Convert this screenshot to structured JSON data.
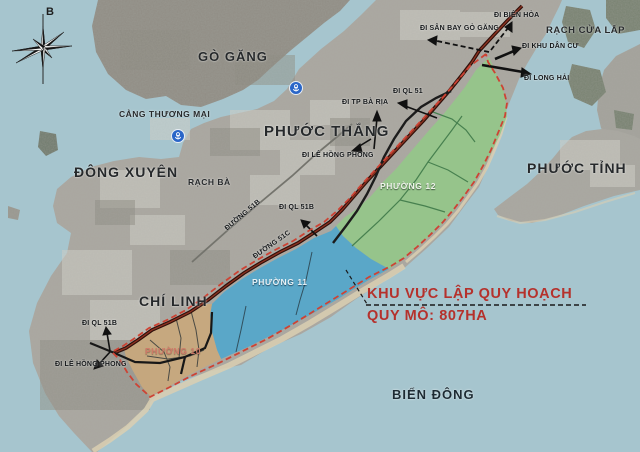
{
  "compass": {
    "north_label": "B"
  },
  "regions": {
    "go_gang": "GÒ GĂNG",
    "phuoc_thang": "PHƯỚC THẮNG",
    "dong_xuyen": "ĐÔNG XUYÊN",
    "phuoc_tinh": "PHƯỚC TỈNH",
    "chi_linh": "CHÍ LINH",
    "bien_dong": "BIỂN ĐÔNG",
    "rach_cua_lap": "RẠCH CỬA LẤP",
    "rach_ba": "RẠCH BÀ",
    "cang_thuong_mai": "CẢNG THƯƠNG MẠI"
  },
  "zones": {
    "p10": {
      "label": "PHƯỜNG 10",
      "color": "#c9a87c"
    },
    "p11": {
      "label": "PHƯỜNG 11",
      "color": "#54a7cb"
    },
    "p12": {
      "label": "PHƯỜNG 12",
      "color": "#95c789"
    }
  },
  "roads": {
    "duong_51b": "ĐƯỜNG 51B",
    "duong_51c": "ĐƯỜNG 51C"
  },
  "directions": {
    "di_san_bay_go_gang": "ĐI SÂN BAY GÒ GĂNG",
    "di_bien_hoa": "ĐI BIÊN HÒA",
    "di_khu_dan_cu": "ĐI KHU DÂN CƯ",
    "di_long_hai": "ĐI LONG HẢI",
    "di_ql_51": "ĐI QL 51",
    "di_tp_ba_ria": "ĐI TP BÀ RỊA",
    "di_le_hong_phong": "ĐI LÊ HỒNG PHONG",
    "di_ql_51b": "ĐI QL 51B",
    "di_ql_51b_south": "ĐI QL 51B",
    "di_le_hong_phong_south": "ĐI LÊ HỒNG PHONG"
  },
  "annotation": {
    "line1": "KHU VỰC LẬP QUY HOẠCH",
    "line2": "QUY MÔ: 807HA"
  },
  "colors": {
    "sea": "#a6c5ce",
    "land": "#a9a7a0",
    "island": "#8f8c84",
    "zone_green": "#95c789",
    "zone_blue": "#54a7cb",
    "zone_tan": "#c9a87c",
    "boundary_red": "#cd4334",
    "annotation_red": "#b5312c",
    "highway_dark": "#2e0f0a"
  }
}
